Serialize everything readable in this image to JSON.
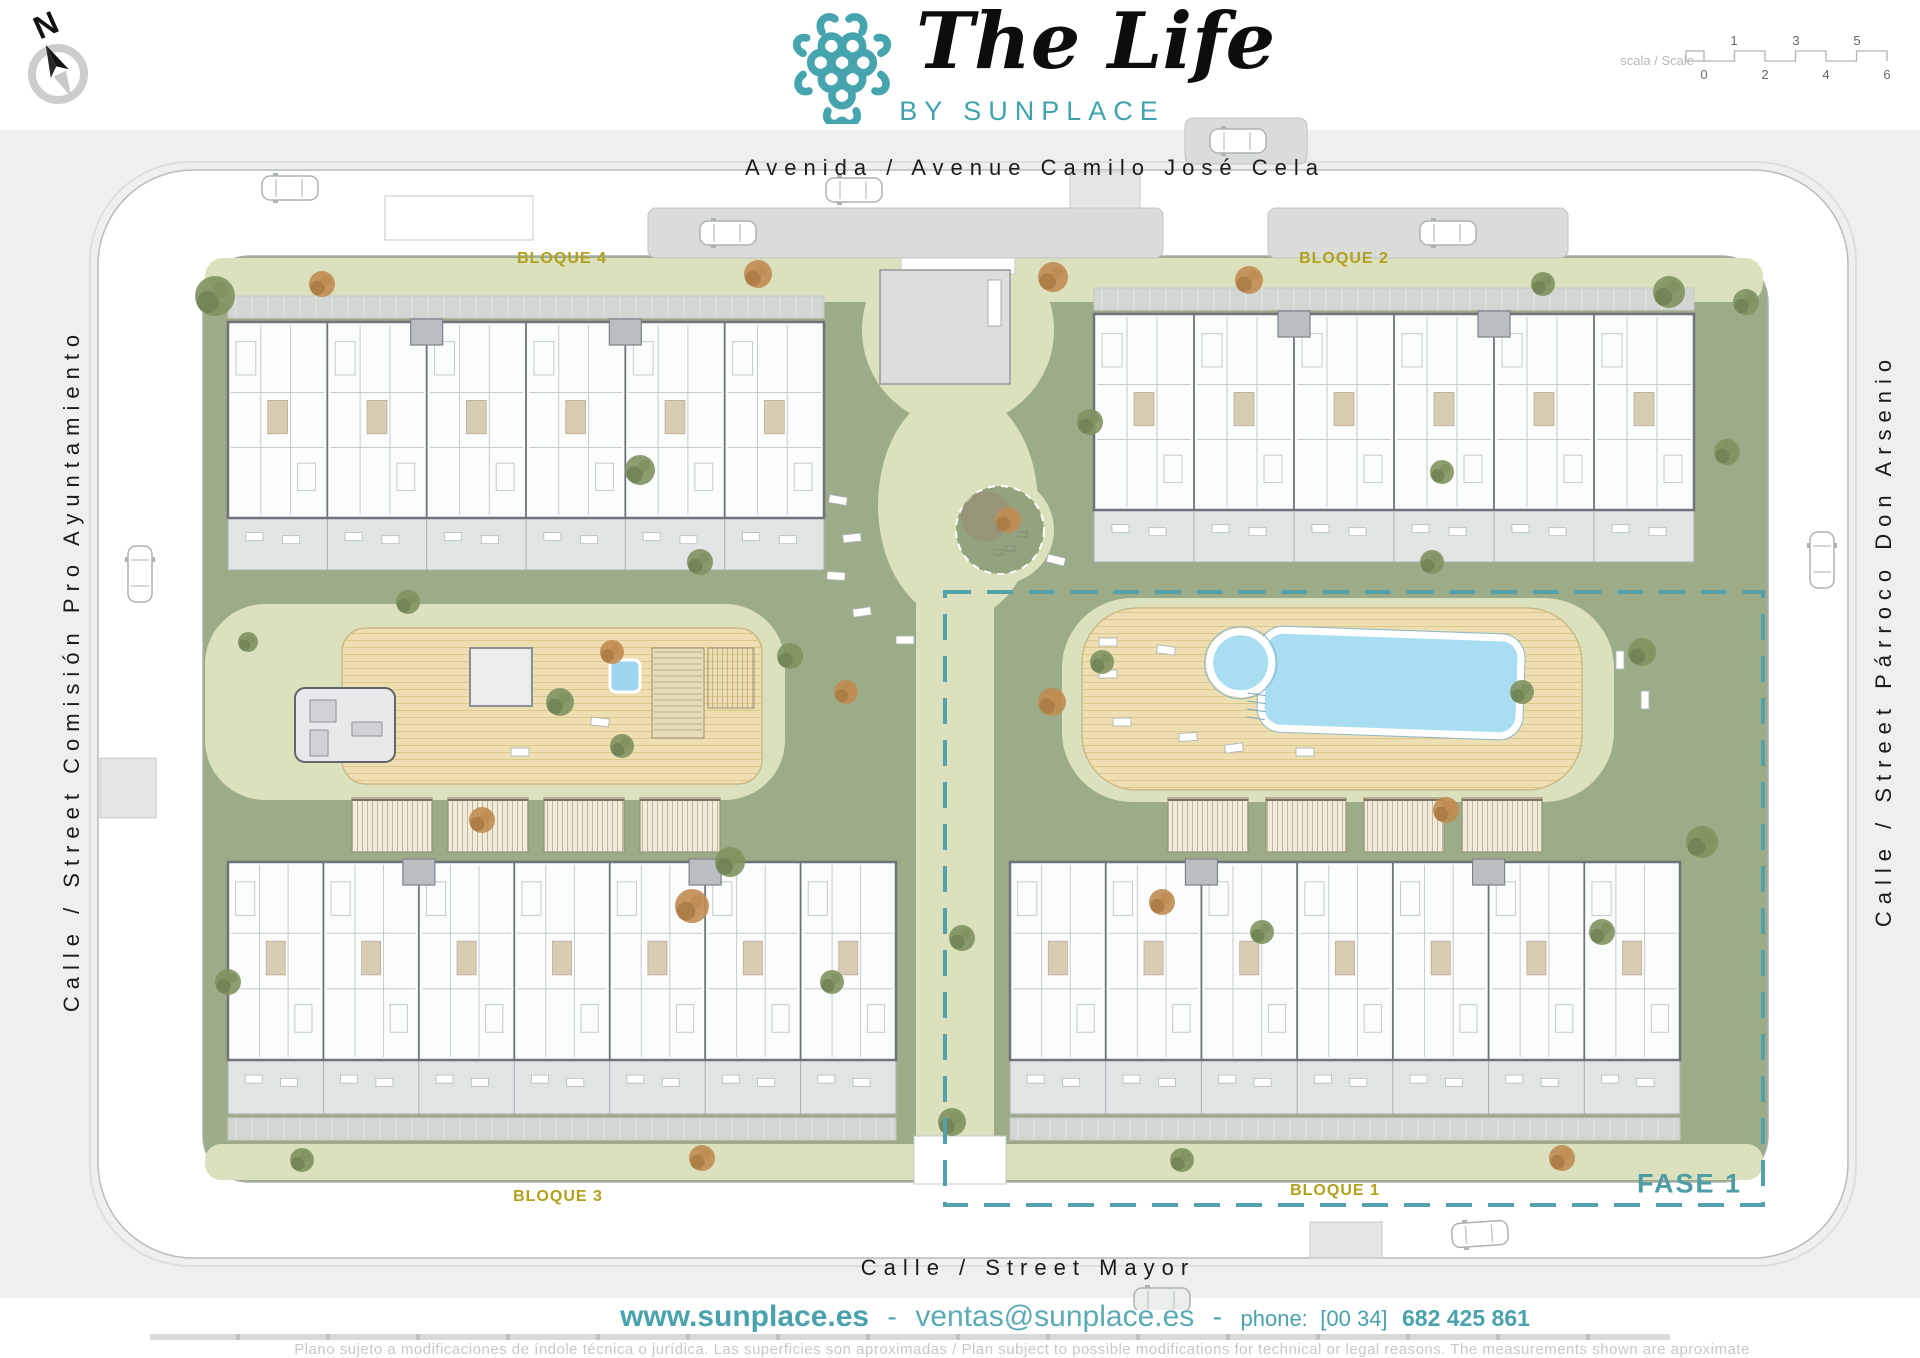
{
  "header": {
    "logo": {
      "title": "The Life",
      "subtitle": "BY SUNPLACE"
    },
    "compass": {
      "label": "N"
    },
    "scale": {
      "label": "Escala / Scale",
      "top_ticks": [
        "1",
        "3",
        "5"
      ],
      "bottom_ticks": [
        "0",
        "2",
        "4",
        "6"
      ]
    }
  },
  "streets": {
    "top": "Avenida / Avenue Camilo José Cela",
    "left": "Calle / Street Comisión Pro Ayuntamiento",
    "right": "Calle / Street Párroco Don Arsenio",
    "bottom": "Calle / Street Mayor"
  },
  "plan": {
    "blocks": [
      {
        "id": "bloque-4",
        "label": "BLOQUE 4"
      },
      {
        "id": "bloque-2",
        "label": "BLOQUE 2"
      },
      {
        "id": "bloque-3",
        "label": "BLOQUE 3"
      },
      {
        "id": "bloque-1",
        "label": "BLOQUE 1"
      }
    ],
    "phase": {
      "label": "FASE 1"
    }
  },
  "footer": {
    "website": "www.sunplace.es",
    "separator": "-",
    "email": "ventas@sunplace.es",
    "phone_label": "phone:",
    "phone_prefix": "[00 34]",
    "phone_number": "682 425 861",
    "disclaimer": "Plano sujeto a modificaciones de índole técnica o jurídica. Las superficies son aproximadas / Plan subject to possible modifications for technical or legal reasons. The measurements shown are aproximate"
  },
  "icons": {
    "logo_mark": "sunplace-knot-icon",
    "compass": "compass-north-icon",
    "scale_bar": "graphic-scale-bar"
  },
  "colors": {
    "brand_teal": "#3fa3ad",
    "fase_teal": "#4d9ca6",
    "block_label_yellow": "#b2a01d",
    "lawn_green": "#9cab88",
    "path_green": "#dce1bd",
    "deck_wood": "#eedfb2",
    "pool_blue": "#a9def2",
    "building_wall_gray": "#6e747a",
    "page_gray": "#efefef"
  }
}
